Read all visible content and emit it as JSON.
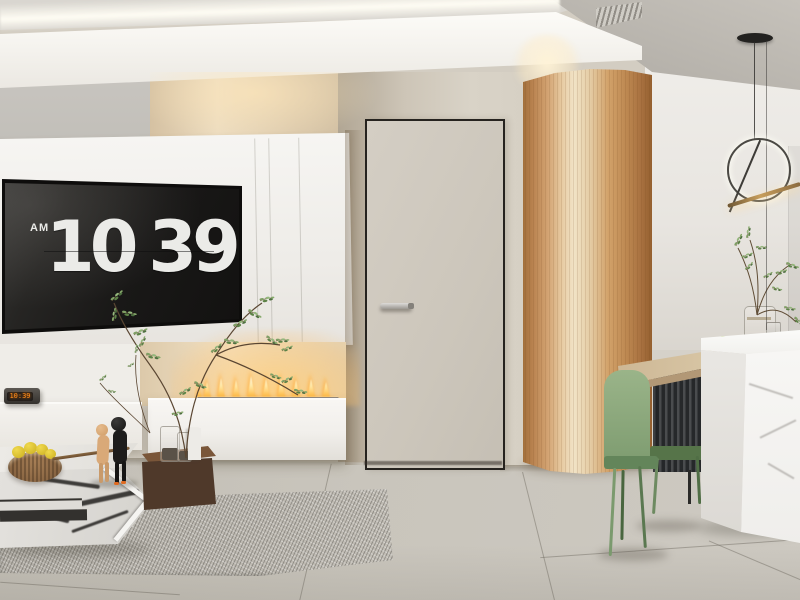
{
  "scene": {
    "type": "interior-3d-render",
    "room": "minimalist living room with media wall, flush door, curved wood partition and dining nook"
  },
  "tv_clock": {
    "meridiem": "AM",
    "hours": "10",
    "minutes": "39"
  },
  "console_clock": {
    "time": "10:39"
  },
  "palette": {
    "wall_beige": "#cfc8bc",
    "media_wall_white": "#f4f2ee",
    "screen_black": "#1b1a19",
    "digit_white": "#ebebe8",
    "fire_orange": "#ff9d2e",
    "led_orange": "#ff8c1a",
    "wood_tan": "#c08a55",
    "walnut_brown": "#4f392a",
    "chair_green": "#85a479",
    "marble_white": "#f5f4f2",
    "floor_grey": "#c3bfb7",
    "rug_grey": "#b7b3ab",
    "ceiling_grey": "#b9b5ae"
  }
}
